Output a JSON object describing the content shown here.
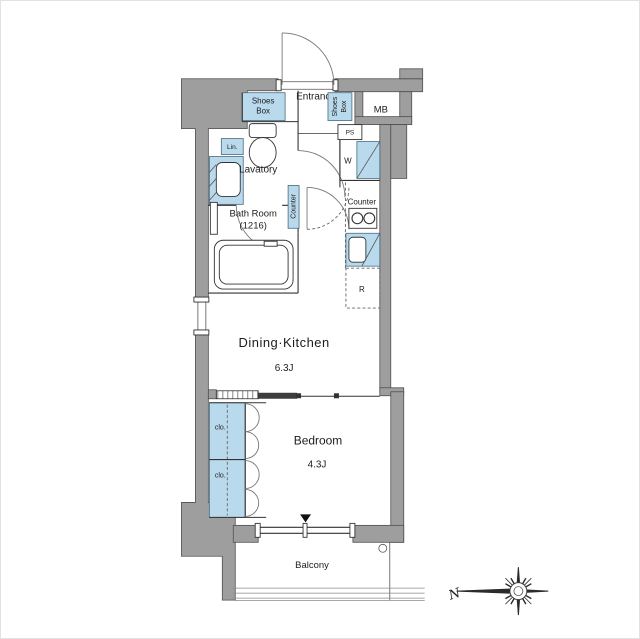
{
  "plan": {
    "colors": {
      "wall": "#9e9e9e",
      "fixture_blue": "#b9d9ec",
      "line": "#333333"
    },
    "rooms": {
      "entrance": {
        "label": "Entrance"
      },
      "lavatory": {
        "label": "Lavatory"
      },
      "bathroom": {
        "label": "Bath Room",
        "size": "(1216)"
      },
      "dining_kitchen": {
        "label": "Dining·Kitchen",
        "size": "6.3J"
      },
      "bedroom": {
        "label": "Bedroom",
        "size": "4.3J"
      },
      "balcony": {
        "label": "Balcony"
      }
    },
    "fixtures": {
      "shoes_box": {
        "line1": "Shoes",
        "line2": "Box"
      },
      "meter_box": {
        "label": "MB"
      },
      "pipe_space": {
        "label": "PS"
      },
      "washer": {
        "label": "W"
      },
      "linen": {
        "label": "Lin."
      },
      "counter_hall": {
        "label": "Counter"
      },
      "counter_kitchen": {
        "label": "Counter"
      },
      "refrigerator": {
        "label": "R"
      },
      "closet_upper": {
        "label": "clo."
      },
      "closet_lower": {
        "label": "clo."
      }
    },
    "compass": {
      "north_label": "N"
    }
  }
}
